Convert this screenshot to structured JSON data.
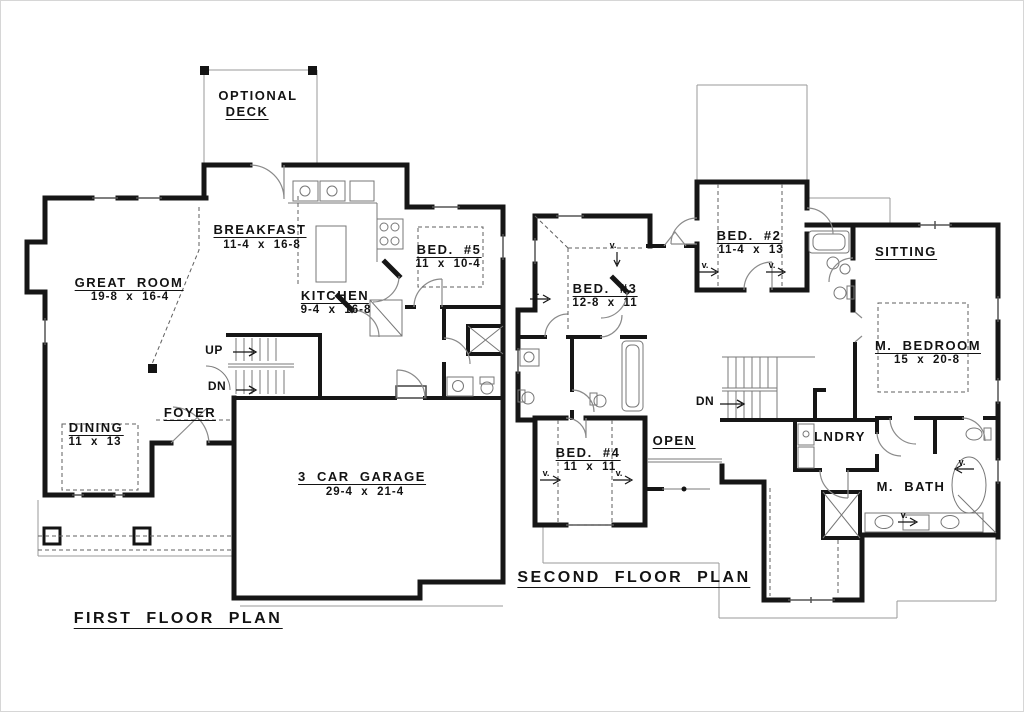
{
  "sheet": {
    "background": "#ffffff",
    "ink": "#141414"
  },
  "v_marker_glyph": "v.",
  "plans": [
    {
      "id": "first-floor",
      "labels": [
        {
          "id": "optional",
          "text": "OPTIONAL",
          "x": 258,
          "y": 89,
          "k": "room"
        },
        {
          "id": "deck",
          "text": "DECK",
          "x": 247,
          "y": 105,
          "k": "room",
          "u": 1
        },
        {
          "id": "breakfast",
          "text": "BREAKFAST",
          "x": 260,
          "y": 223,
          "k": "room",
          "u": 1
        },
        {
          "id": "breakfast-dims",
          "text": "11-4  x  16-8",
          "x": 262,
          "y": 240,
          "k": "dims"
        },
        {
          "id": "kitchen",
          "text": "KITCHEN",
          "x": 335,
          "y": 289,
          "k": "room",
          "u": 1
        },
        {
          "id": "kitchen-dims",
          "text": "9-4  x  16-8",
          "x": 336,
          "y": 305,
          "k": "dims"
        },
        {
          "id": "great-room",
          "text": "GREAT  ROOM",
          "x": 129,
          "y": 276,
          "k": "room",
          "u": 1
        },
        {
          "id": "great-room-dims",
          "text": "19-8  x  16-4",
          "x": 130,
          "y": 292,
          "k": "dims"
        },
        {
          "id": "dining",
          "text": "DINING",
          "x": 96,
          "y": 421,
          "k": "room",
          "u": 1
        },
        {
          "id": "dining-dims",
          "text": "11  x  13",
          "x": 95,
          "y": 437,
          "k": "dims"
        },
        {
          "id": "foyer",
          "text": "FOYER",
          "x": 190,
          "y": 406,
          "k": "room",
          "u": 1
        },
        {
          "id": "bed5",
          "text": "BED.  #5",
          "x": 449,
          "y": 243,
          "k": "room",
          "u": 1
        },
        {
          "id": "bed5-dims",
          "text": "11  x  10-4",
          "x": 448,
          "y": 259,
          "k": "dims"
        },
        {
          "id": "garage",
          "text": "3  CAR  GARAGE",
          "x": 362,
          "y": 470,
          "k": "room",
          "u": 1
        },
        {
          "id": "garage-dims",
          "text": "29-4  x  21-4",
          "x": 365,
          "y": 487,
          "k": "dims"
        },
        {
          "id": "up",
          "text": "UP",
          "x": 214,
          "y": 344,
          "k": "small"
        },
        {
          "id": "dn",
          "text": "DN",
          "x": 217,
          "y": 380,
          "k": "small"
        },
        {
          "id": "title",
          "text": "FIRST  FLOOR  PLAN",
          "x": 178,
          "y": 611,
          "k": "title",
          "u": 1
        }
      ],
      "v_markers": []
    },
    {
      "id": "second-floor",
      "labels": [
        {
          "id": "bed2",
          "text": "BED.  #2",
          "x": 749,
          "y": 229,
          "k": "room",
          "u": 1
        },
        {
          "id": "bed2-dims",
          "text": "11-4  x  13",
          "x": 751,
          "y": 245,
          "k": "dims"
        },
        {
          "id": "bed3",
          "text": "BED.  #3",
          "x": 605,
          "y": 282,
          "k": "room",
          "u": 1
        },
        {
          "id": "bed3-dims",
          "text": "12-8  x  11",
          "x": 605,
          "y": 298,
          "k": "dims"
        },
        {
          "id": "bed4",
          "text": "BED.  #4",
          "x": 588,
          "y": 446,
          "k": "room",
          "u": 1
        },
        {
          "id": "bed4-dims",
          "text": "11  x  11",
          "x": 590,
          "y": 462,
          "k": "dims"
        },
        {
          "id": "sitting",
          "text": "SITTING",
          "x": 906,
          "y": 245,
          "k": "room",
          "u": 1
        },
        {
          "id": "m-bedroom",
          "text": "M.  BEDROOM",
          "x": 928,
          "y": 339,
          "k": "room",
          "u": 1
        },
        {
          "id": "m-bedroom-dims",
          "text": "15  x  20-8",
          "x": 927,
          "y": 355,
          "k": "dims"
        },
        {
          "id": "m-bath",
          "text": "M.  BATH",
          "x": 911,
          "y": 480,
          "k": "room"
        },
        {
          "id": "lndry",
          "text": "LNDRY",
          "x": 840,
          "y": 430,
          "k": "room"
        },
        {
          "id": "open",
          "text": "OPEN",
          "x": 674,
          "y": 434,
          "k": "room",
          "u": 1
        },
        {
          "id": "dn",
          "text": "DN",
          "x": 705,
          "y": 395,
          "k": "small"
        },
        {
          "id": "title",
          "text": "SECOND  FLOOR  PLAN",
          "x": 634,
          "y": 570,
          "k": "title",
          "u": 1
        }
      ],
      "v_markers": [
        {
          "x": 613,
          "y": 241
        },
        {
          "x": 536,
          "y": 288
        },
        {
          "x": 705,
          "y": 261
        },
        {
          "x": 772,
          "y": 261
        },
        {
          "x": 546,
          "y": 469
        },
        {
          "x": 619,
          "y": 469
        },
        {
          "x": 962,
          "y": 458
        },
        {
          "x": 904,
          "y": 511
        }
      ]
    }
  ]
}
